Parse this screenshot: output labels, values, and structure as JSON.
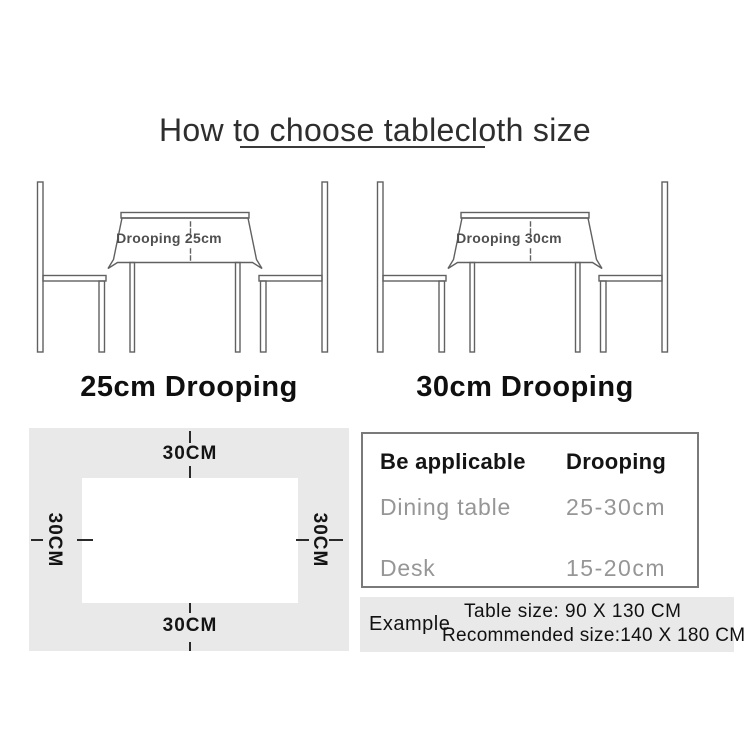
{
  "title": "How to choose tablecloth size",
  "diagrams": [
    {
      "drooping_label": "Drooping 25cm",
      "caption": "25cm Drooping"
    },
    {
      "drooping_label": "Drooping 30cm",
      "caption": "30cm Drooping"
    }
  ],
  "size_diagram": {
    "top": "30CM",
    "right": "30CM",
    "bottom": "30CM",
    "left": "30CM"
  },
  "spec_table": {
    "headers": [
      "Be applicable",
      "Drooping"
    ],
    "rows": [
      [
        "Dining table",
        "25-30cm"
      ],
      [
        "Desk",
        "15-20cm"
      ]
    ]
  },
  "example": {
    "label": "Example",
    "table_size": "Table size:  90 X 130 CM",
    "recommended_size": "Recommended size:140 X 180 CM"
  },
  "colors": {
    "panel_gray": "#e9e9e9",
    "line_art_gray": "#616161",
    "muted_text_gray": "#969696",
    "ink": "#141414"
  }
}
